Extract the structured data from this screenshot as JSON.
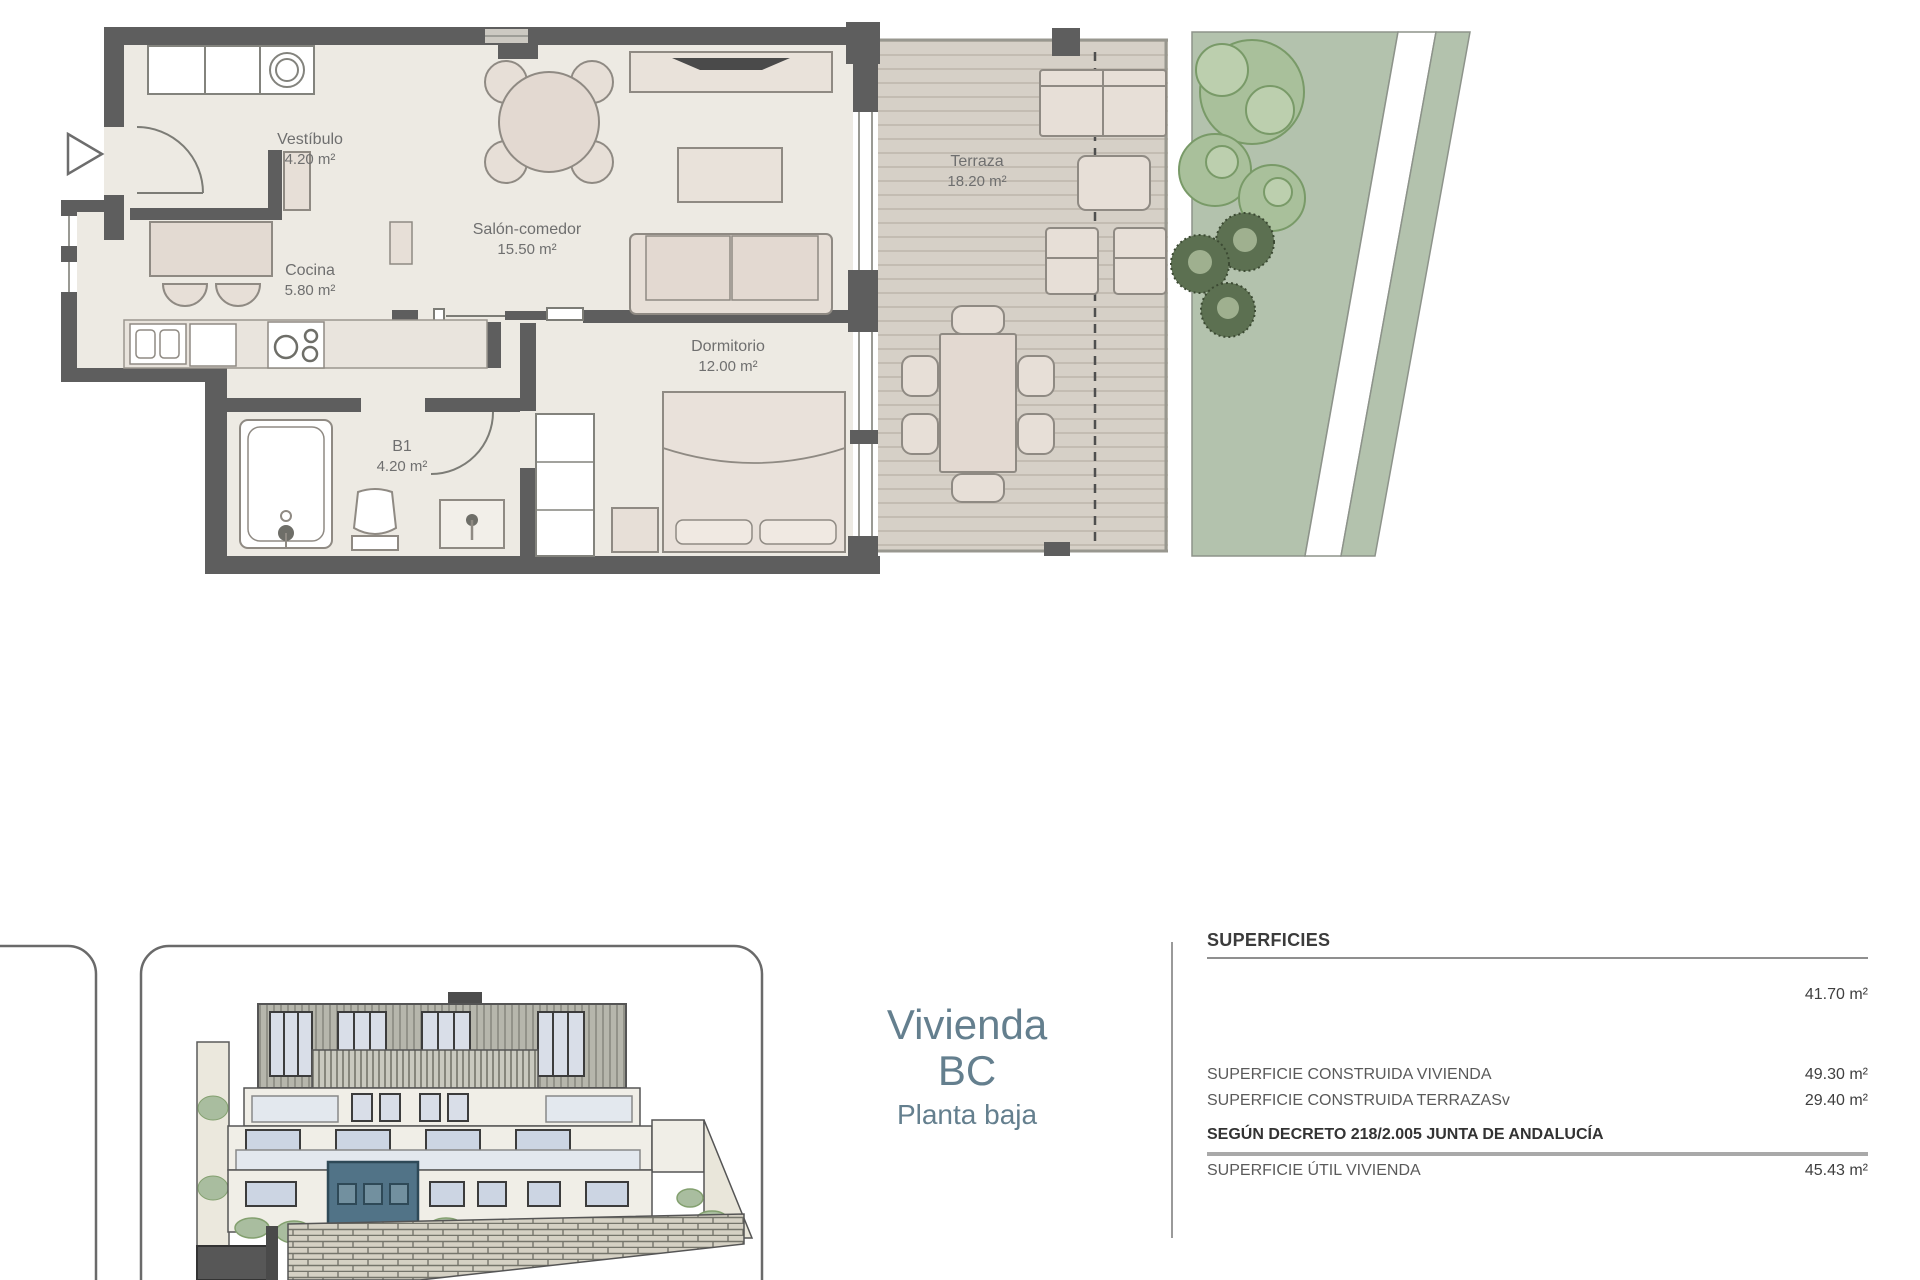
{
  "floor_plan": {
    "rooms": [
      {
        "name": "Vestíbulo",
        "area": "4.20 m²"
      },
      {
        "name": "Cocina",
        "area": "5.80 m²"
      },
      {
        "name": "Salón-comedor",
        "area": "15.50 m²"
      },
      {
        "name": "B1",
        "area": "4.20 m²"
      },
      {
        "name": "Dormitorio",
        "area": "12.00 m²"
      },
      {
        "name": "Terraza",
        "area": "18.20 m²"
      }
    ]
  },
  "unit_card": {
    "title_line1": "Vivienda",
    "title_line2": "BC",
    "subtitle": "Planta baja"
  },
  "surface_table": {
    "header": "SUPERFICIES",
    "rows": [
      {
        "label": "",
        "value": "41.70 m²"
      },
      {
        "label": "SUPERFICIE CONSTRUIDA VIVIENDA",
        "value": "49.30 m²"
      },
      {
        "label": "SUPERFICIE CONSTRUIDA TERRAZASv",
        "value": "29.40 m²"
      }
    ],
    "section_header": "SEGÚN DECRETO 218/2.005 JUNTA DE ANDALUCÍA",
    "rows2": [
      {
        "label": "SUPERFICIE ÚTIL VIVIENDA",
        "value": "45.43 m²"
      }
    ]
  },
  "colors": {
    "wall": "#5e5e5e",
    "floor": "#edeae3",
    "furniture": "#e7dfd7",
    "deck": "#d6d0c7",
    "sage": "#b3c2ad",
    "bush_light": "#a9c09b",
    "bush_dark": "#5c7051",
    "highlight_unit": "#517387",
    "unit_text": "#647f8e"
  }
}
